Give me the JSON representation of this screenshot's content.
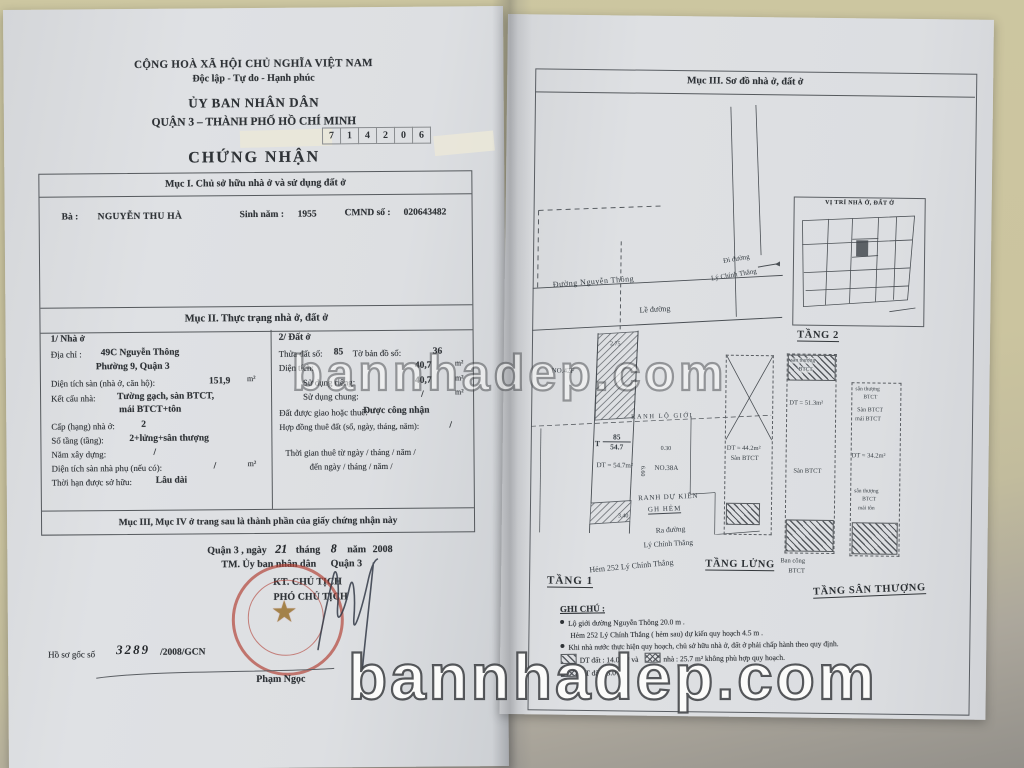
{
  "watermarks": {
    "center": "bannhadep.com",
    "bottom": "bannhadep.com"
  },
  "left_page": {
    "header": {
      "country": "CỘNG HOÀ XÃ HỘI CHỦ NGHĨA VIỆT NAM",
      "motto": "Độc lập - Tự do - Hạnh phúc",
      "committee": "ỦY BAN NHÂN DÂN",
      "district": "QUẬN 3 – THÀNH PHỐ HỒ CHÍ MINH",
      "serial": [
        "7",
        "1",
        "4",
        "2",
        "0",
        "6"
      ],
      "title": "CHỨNG NHẬN"
    },
    "section1": {
      "heading": "Mục I. Chủ sở hữu nhà ở và sử dụng đất ở",
      "owner_label": "Bà :",
      "owner_name": "NGUYỄN THU HÀ",
      "birth_label": "Sinh năm :",
      "birth_year": "1955",
      "id_label": "CMND số :",
      "id_number": "020643482"
    },
    "section2": {
      "heading": "Mục II. Thực trạng nhà ở, đất ở",
      "house": {
        "title": "1/ Nhà ở",
        "address_label": "Địa chỉ :",
        "address_line1": "49C Nguyễn Thông",
        "address_line2": "Phường 9, Quận 3",
        "floor_area_label": "Diện tích sàn (nhà ở, căn hộ):",
        "floor_area": "151,9",
        "floor_area_unit": "m²",
        "structure_label": "Kết cấu nhà:",
        "structure_line1": "Tường gạch, sàn BTCT,",
        "structure_line2": "mái BTCT+tôn",
        "grade_label": "Cấp (hạng) nhà ở:",
        "grade": "2",
        "storeys_label": "Số tầng (tầng):",
        "storeys": "2+lửng+sân thượng",
        "built_year_label": "Năm xây dựng:",
        "built_year": "/",
        "aux_area_label": "Diện tích sàn nhà phụ (nếu có):",
        "aux_area": "/",
        "aux_area_unit": "m²",
        "tenure_label": "Thời hạn được sở hữu:",
        "tenure": "Lâu dài"
      },
      "land": {
        "title": "2/ Đất ở",
        "parcel_label": "Thửa đất số:",
        "parcel": "85",
        "map_label": "Tờ bản đồ số:",
        "map_no": "36",
        "area_label": "Diện tích:",
        "area": "40,7",
        "area_unit": "m²",
        "private_label": "Sử dụng riêng:",
        "private_area": "40,7",
        "private_unit": "m²",
        "common_label": "Sử dụng chung:",
        "common_area": "/",
        "common_unit": "m²",
        "granted_label": "Đất được giao hoặc thuê:",
        "granted": "Được công nhận",
        "lease_label": "Hợp đồng thuê đất (số, ngày, tháng, năm):",
        "lease": "/",
        "lease_from": "Thời gian thuê từ ngày / tháng / năm /",
        "lease_to": "đến ngày / tháng / năm /"
      }
    },
    "section3_note": "Mục III, Mục IV ở trang sau là thành phần của giấy chứng nhận này",
    "signing": {
      "place": "Quận 3 , ngày",
      "day": "21",
      "month_label": "tháng",
      "month": "8",
      "year_label": "năm",
      "year": "2008",
      "on_behalf": "TM. Ủy ban nhân dân",
      "on_behalf_unit": "Quận 3",
      "title_line1": "KT. CHỦ TỊCH",
      "title_line2": "PHÓ CHỦ TỊCH",
      "signer": "Phạm Ngọc",
      "dossier_label": "Hồ sơ gốc số",
      "dossier_no": "3289",
      "dossier_suffix": "/2008/GCN"
    }
  },
  "right_page": {
    "heading": "Mục III. Sơ đồ nhà ở, đất ở",
    "location_map_title": "VỊ TRÍ NHÀ Ở, ĐẤT Ở",
    "plan": {
      "street_top": "Đường Nguyễn Thông",
      "to_street_line1": "Đi đường",
      "to_street_line2": "Lý Chính Thắng",
      "sidewalk": "Lề đường",
      "neighbor_left": "NO.42F",
      "boundary_line": "RANH LỘ GIỚI",
      "neighbor_right": "NO.38A",
      "parcel_prefix": "T",
      "parcel_no": "85",
      "parcel_area": "54.7",
      "parcel_dt": "DT = 54.7m²",
      "planned_boundary_line1": "RANH DỰ KIẾN",
      "planned_boundary_line2": "GH HẺM",
      "out_street_line1": "Ra đường",
      "out_street_line2": "Lý Chính Thắng",
      "alley": "Hẻm 252 Lý Chính Thắng",
      "floor1_label": "TẦNG 1",
      "floor2_label": "TẦNG 2",
      "mezzanine_label": "TẦNG LỬNG",
      "roof_label": "TẦNG SÂN THƯỢNG",
      "mezz_dt": "DT = 44.2m²",
      "mezz_floor": "Sàn BTCT",
      "floor2_terrace_1": "sân thượng",
      "floor2_terrace_2": "BTCT",
      "floor2_dt": "DT = 51.3m²",
      "floor2_floor": "Sàn BTCT",
      "balcony_line1": "Ban công",
      "balcony_line2": "BTCT",
      "roof_terrace_1": "sân thượng",
      "roof_terrace_2": "BTCT",
      "roof_floor": "Sàn BTCT",
      "roof_mai": "mái BTCT",
      "roof_dt": "DT = 34.2m²",
      "roof_terrace2_1": "sân thượng",
      "roof_terrace2_2": "BTCT",
      "roof_mai_ton": "mái tôn",
      "dims": {
        "d1": "2.75",
        "d2": "0.30",
        "d3": "3.40",
        "d4": "6.60"
      }
    },
    "notes": {
      "heading": "GHI CHÚ :",
      "line1": "Lộ giới đường Nguyễn Thông 20.0 m .",
      "line2": "Hẻm 252 Lý Chính Thắng ( hẻm sau) dự kiến quy hoạch 4.5 m .",
      "line3": "Khi nhà nước thực hiện quy hoạch, chủ sở hữu nhà ở, đất ở phải chấp hành theo quy định.",
      "legend1_a": "DT đất : 14.0 m² và",
      "legend1_b": "nhà : 25.7 m² không phù hợp quy hoạch.",
      "legend2": "DT đất : 3.0 m²"
    }
  }
}
